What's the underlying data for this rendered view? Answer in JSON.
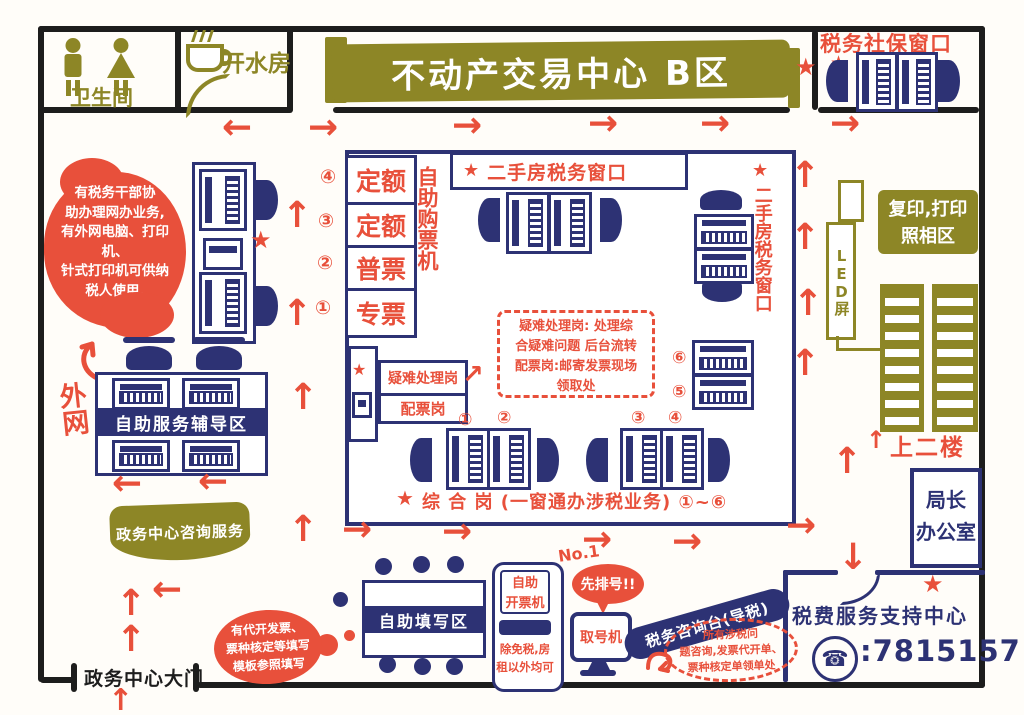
{
  "colors": {
    "red": "#e8503b",
    "navy": "#2d3274",
    "olive": "#8d8626",
    "black": "#1d1d1d"
  },
  "top": {
    "restroom_label": "卫生间",
    "hot_water_label": "开水房",
    "title": "不动产交易中心 B区",
    "social_security_window": "税务社保窗口"
  },
  "left": {
    "helper_note": "有税务干部协\n助办理网办业务,\n有外网电脑、打印机、\n针式打印机可供纳\n税人使用.",
    "extranet": "外网",
    "self_service_zone": "自助服务辅导区",
    "consult_ribbon": "政务中心咨询服务",
    "gate": "政务中心大门"
  },
  "ticket_machines": {
    "side_label": "自助购票机",
    "items": [
      {
        "num": "④",
        "label": "定额"
      },
      {
        "num": "③",
        "label": "定额"
      },
      {
        "num": "②",
        "label": "普票"
      },
      {
        "num": "①",
        "label": "专票"
      }
    ]
  },
  "hall": {
    "top_window": "二手房税务窗口",
    "right_window": "二手房税务窗口",
    "difficult_post": "疑难处理岗",
    "ticket_post": "配票岗",
    "dashed_note": "疑难处理岗: 处理综\n合疑难问题 后台流转\n配票岗:邮寄发票现场\n领取处",
    "desk_numbers": [
      "①",
      "②",
      "③",
      "④",
      "⑤",
      "⑥"
    ],
    "bottom_label": "综 合 岗 (一窗通办涉税业务) ①~⑥"
  },
  "right": {
    "copy_print_area": "复印,打印\n照相区",
    "led_screen": "LED屏",
    "upstairs": "上二楼",
    "director_office": "局长\n办公室",
    "support_center": "税费服务支持中心",
    "support_phone": ":7815157"
  },
  "bottom": {
    "fill_area": "自助填写区",
    "invoice_machine": "自助\n开票机",
    "invoice_note": "除免税,房\n租以外均可",
    "number_machine": "取号机",
    "queue_bubble": "先排号!!",
    "no1": "No.1",
    "consult_desk": "税务咨询台(导税)",
    "consult_note": "所有涉税问\n题咨询,发票代开单、\n票种核定单领单处",
    "template_note": "有代开发票、\n票种核定等填写\n模板参照填写"
  }
}
